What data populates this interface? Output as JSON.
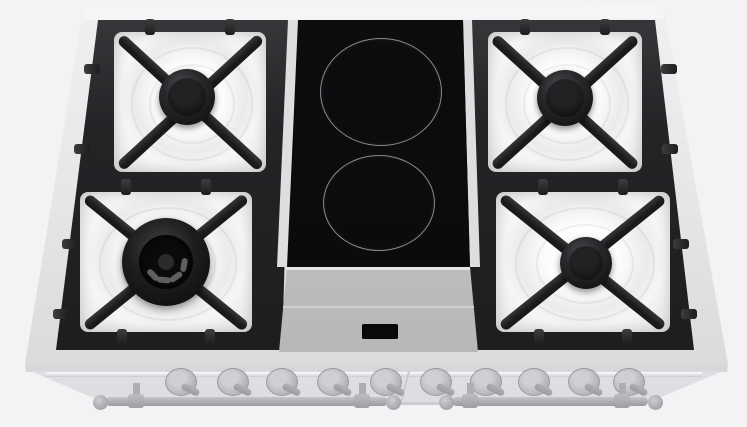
{
  "meta": {
    "description": "Top view 3D render of a 90 cm dual-fuel range cooktop: four gas burners on black cast-iron grates, a central two-zone black ceramic module with a small control display, and a ghosted front panel with ten control knobs and two oven door handles",
    "visible_text": "",
    "knob_count": 10,
    "gas_burner_count": 4,
    "ceramic_zone_count": 2,
    "door_handle_count": 2
  },
  "palette": {
    "background": "#f3f3f5",
    "rim": "#e7e7e9",
    "rim_highlight": "#f5f5f7",
    "grate_dark": "#232326",
    "enamel_white": "#f6f6f7",
    "ceramic_glass": "#0b0b0c",
    "zone_ring": "#8b8b8f",
    "control_panel": "#c0c1c3",
    "display_off": "#0a0a0b",
    "ghost_front": "#e6e7ea",
    "knob_gray": "#b0b1b4",
    "handle_gray": "#a5a6a9"
  },
  "cooktop": {
    "outline": [
      [
        84,
        6
      ],
      [
        663,
        5
      ],
      [
        728,
        364
      ],
      [
        25,
        364
      ]
    ],
    "top_band": [
      [
        84,
        6
      ],
      [
        663,
        5
      ],
      [
        664,
        19
      ],
      [
        82,
        20
      ]
    ],
    "front_lip": [
      [
        25,
        364
      ],
      [
        728,
        364
      ],
      [
        727,
        372
      ],
      [
        26,
        372
      ]
    ],
    "zones": [
      {
        "name": "left-grate",
        "poly": [
          [
            98,
            20
          ],
          [
            292,
            20
          ],
          [
            282,
            350
          ],
          [
            56,
            350
          ]
        ],
        "side_tabs": [
          [
            84,
            64
          ],
          [
            74,
            144
          ],
          [
            62,
            239
          ],
          [
            53,
            309
          ]
        ],
        "cells": [
          {
            "name": "rear-left-gas-burner",
            "bowl": [
              114,
              32,
              152,
              140
            ],
            "tabs_bottom": false,
            "burner": {
              "type": "standard",
              "cx": 187,
              "cy": 97,
              "r": 28
            }
          },
          {
            "name": "front-left-gas-burner",
            "bowl": [
              80,
              192,
              172,
              140
            ],
            "tabs_bottom": true,
            "burner": {
              "type": "dual-ring",
              "cx": 166,
              "cy": 262,
              "r": 44
            }
          }
        ]
      },
      {
        "name": "right-grate",
        "poly": [
          [
            460,
            20
          ],
          [
            655,
            20
          ],
          [
            694,
            350
          ],
          [
            470,
            350
          ]
        ],
        "side_tabs": [
          [
            661,
            64
          ],
          [
            662,
            144
          ],
          [
            673,
            239
          ],
          [
            681,
            309
          ]
        ],
        "cells": [
          {
            "name": "rear-right-gas-burner",
            "bowl": [
              488,
              32,
              154,
              140
            ],
            "tabs_bottom": false,
            "burner": {
              "type": "standard",
              "cx": 565,
              "cy": 98,
              "r": 28
            }
          },
          {
            "name": "front-right-gas-burner",
            "bowl": [
              496,
              192,
              174,
              140
            ],
            "tabs_bottom": true,
            "burner": {
              "type": "standard",
              "cx": 586,
              "cy": 263,
              "r": 26
            }
          }
        ]
      }
    ]
  },
  "ceramic_module": {
    "left_strip": [
      [
        288,
        20
      ],
      [
        298,
        20
      ],
      [
        287,
        267
      ],
      [
        277,
        267
      ]
    ],
    "right_strip": [
      [
        463,
        20
      ],
      [
        472,
        20
      ],
      [
        480,
        267
      ],
      [
        470,
        267
      ]
    ],
    "glass": [
      [
        298,
        20
      ],
      [
        463,
        20
      ],
      [
        470,
        267
      ],
      [
        287,
        267
      ]
    ],
    "zones": [
      {
        "name": "rear-ceramic-zone",
        "cx": 380,
        "cy": 91,
        "rx": 60,
        "ry": 53
      },
      {
        "name": "front-ceramic-zone",
        "cx": 378,
        "cy": 202,
        "rx": 55,
        "ry": 47
      }
    ],
    "control_panel": [
      [
        287,
        267
      ],
      [
        470,
        267
      ],
      [
        478,
        352
      ],
      [
        279,
        352
      ]
    ],
    "panel_top_line": [
      [
        287,
        267
      ],
      [
        470,
        267
      ],
      [
        470,
        270
      ],
      [
        287,
        270
      ]
    ],
    "panel_crease": [
      [
        283,
        306
      ],
      [
        474,
        306
      ],
      [
        474,
        308
      ],
      [
        283,
        308
      ]
    ],
    "display": {
      "x": 362,
      "y": 324,
      "w": 36,
      "h": 15,
      "state": "off"
    }
  },
  "front_panel": {
    "face": [
      [
        30,
        371
      ],
      [
        723,
        371
      ],
      [
        645,
        404
      ],
      [
        108,
        404
      ]
    ],
    "rail_top": [
      46,
      372,
      656,
      2
    ],
    "rail_bottom": [
      46,
      375.5,
      656,
      1.5
    ],
    "bottom_line": [
      [
        108,
        402
      ],
      [
        645,
        402
      ],
      [
        643,
        405
      ],
      [
        110,
        405
      ]
    ],
    "door_seam": {
      "x": 408,
      "y": 371,
      "len": 34,
      "angle_deg": 14
    },
    "knobs": {
      "y": 381,
      "xs": [
        180,
        232,
        281,
        332,
        385,
        435,
        485,
        533,
        583,
        628
      ]
    },
    "handles": [
      {
        "name": "left-door-handle",
        "x1": 106,
        "x2": 388,
        "y": 397,
        "balls": [
          100,
          393
        ],
        "brackets": [
          136,
          362
        ]
      },
      {
        "name": "right-door-handle",
        "x1": 452,
        "x2": 648,
        "y": 397,
        "balls": [
          446,
          655
        ],
        "brackets": [
          470,
          622
        ]
      }
    ]
  }
}
